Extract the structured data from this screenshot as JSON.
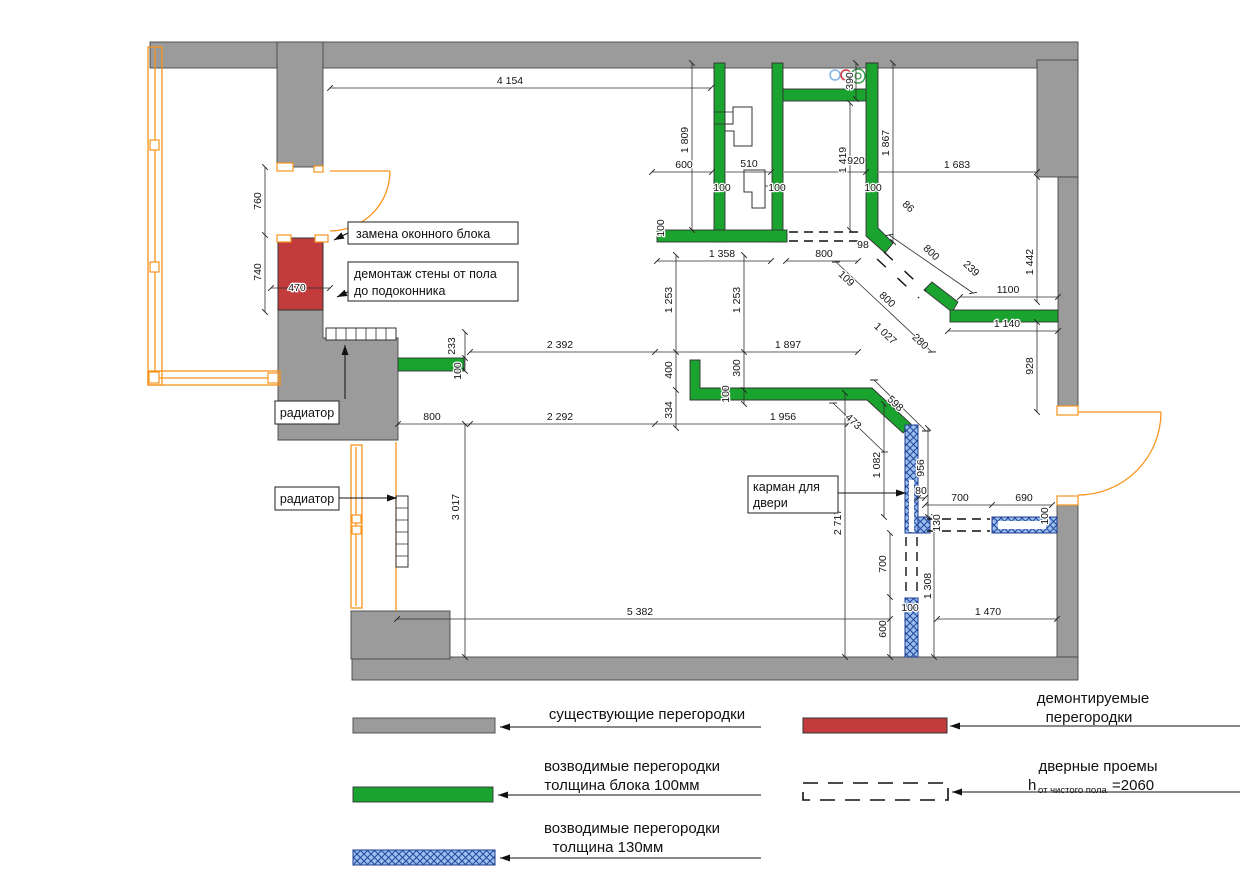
{
  "colors": {
    "wall_existing": "#9b9b9b",
    "wall_new_100": "#1aa32e",
    "wall_new_130_fill": "#9cc0ee",
    "wall_new_130_hatch": "#274a9e",
    "wall_demolished": "#c23b3d",
    "window_frame": "#f7941d",
    "riser_blue": "#85b7e8",
    "riser_red": "#d23a3a",
    "riser_green": "#2f9e44"
  },
  "plan_labels": {
    "window_replacement": "замена оконного блока",
    "wall_demolition_line1": "демонтаж стены от пола",
    "wall_demolition_line2": "до подоконника",
    "radiator_top": "радиатор",
    "radiator_left": "радиатор",
    "door_pocket_line1": "карман для",
    "door_pocket_line2": "двери"
  },
  "legend": {
    "existing": "существующие перегородки",
    "new100_line1": "возводимые перегородки",
    "new100_line2": "толщина блока 100мм",
    "new130_line1": "возводимые перегородки",
    "new130_line2": "толщина  130мм",
    "demolished_line1": "демонтируемые",
    "demolished_line2": "перегородки",
    "door_line1": "дверные проемы",
    "door_h": "h",
    "door_h_sub": "от чистого пола",
    "door_h_value": "=2060"
  },
  "dimensions": [
    {
      "t": "4 154",
      "x": 510,
      "y": 84,
      "r": 0
    },
    {
      "t": "600",
      "x": 684,
      "y": 168,
      "r": 0
    },
    {
      "t": "510",
      "x": 749,
      "y": 167,
      "r": 0
    },
    {
      "t": "920",
      "x": 856,
      "y": 164,
      "r": 0
    },
    {
      "t": "1 683",
      "x": 957,
      "y": 168,
      "r": 0
    },
    {
      "t": "100",
      "x": 722,
      "y": 191,
      "r": 0
    },
    {
      "t": "100",
      "x": 777,
      "y": 191,
      "r": 0
    },
    {
      "t": "100",
      "x": 873,
      "y": 191,
      "r": 0
    },
    {
      "t": "1 358",
      "x": 722,
      "y": 257,
      "r": 0
    },
    {
      "t": "800",
      "x": 824,
      "y": 257,
      "r": 0
    },
    {
      "t": "98",
      "x": 863,
      "y": 248,
      "r": 0
    },
    {
      "t": "470",
      "x": 297,
      "y": 291,
      "r": 0
    },
    {
      "t": "2 392",
      "x": 560,
      "y": 348,
      "r": 0
    },
    {
      "t": "1 897",
      "x": 788,
      "y": 348,
      "r": 0
    },
    {
      "t": "800",
      "x": 432,
      "y": 420,
      "r": 0
    },
    {
      "t": "2 292",
      "x": 560,
      "y": 420,
      "r": 0
    },
    {
      "t": "1 956",
      "x": 783,
      "y": 420,
      "r": 0
    },
    {
      "t": "1100",
      "x": 1008,
      "y": 293,
      "r": 0
    },
    {
      "t": "1 140",
      "x": 1007,
      "y": 327,
      "r": 0
    },
    {
      "t": "700",
      "x": 960,
      "y": 501,
      "r": 0
    },
    {
      "t": "690",
      "x": 1024,
      "y": 501,
      "r": 0
    },
    {
      "t": "80",
      "x": 921,
      "y": 494,
      "r": 0
    },
    {
      "t": "5 382",
      "x": 640,
      "y": 615,
      "r": 0
    },
    {
      "t": "1 470",
      "x": 988,
      "y": 615,
      "r": 0
    },
    {
      "t": "100",
      "x": 910,
      "y": 611,
      "r": 0
    },
    {
      "t": "760",
      "x": 261,
      "y": 201,
      "r": -90
    },
    {
      "t": "740",
      "x": 261,
      "y": 272,
      "r": -90
    },
    {
      "t": "1 809",
      "x": 688,
      "y": 140,
      "r": -90
    },
    {
      "t": "390",
      "x": 853,
      "y": 81,
      "r": -90
    },
    {
      "t": "1 419",
      "x": 846,
      "y": 160,
      "r": -90
    },
    {
      "t": "1 867",
      "x": 889,
      "y": 143,
      "r": -90
    },
    {
      "t": "1 442",
      "x": 1033,
      "y": 262,
      "r": -90
    },
    {
      "t": "928",
      "x": 1033,
      "y": 366,
      "r": -90
    },
    {
      "t": "100",
      "x": 664,
      "y": 228,
      "r": -90
    },
    {
      "t": "1 253",
      "x": 672,
      "y": 300,
      "r": -90
    },
    {
      "t": "1 253",
      "x": 740,
      "y": 300,
      "r": -90
    },
    {
      "t": "400",
      "x": 672,
      "y": 370,
      "r": -90
    },
    {
      "t": "334",
      "x": 672,
      "y": 410,
      "r": -90
    },
    {
      "t": "300",
      "x": 740,
      "y": 368,
      "r": -90
    },
    {
      "t": "100",
      "x": 729,
      "y": 394,
      "r": -90
    },
    {
      "t": "233",
      "x": 455,
      "y": 346,
      "r": -90
    },
    {
      "t": "100",
      "x": 461,
      "y": 371,
      "r": -90
    },
    {
      "t": "3 017",
      "x": 459,
      "y": 507,
      "r": -90
    },
    {
      "t": "2 717",
      "x": 841,
      "y": 522,
      "r": -90
    },
    {
      "t": "1 082",
      "x": 880,
      "y": 465,
      "r": -90
    },
    {
      "t": "956",
      "x": 924,
      "y": 468,
      "r": -90
    },
    {
      "t": "130",
      "x": 940,
      "y": 523,
      "r": -90
    },
    {
      "t": "100",
      "x": 1048,
      "y": 516,
      "r": -90
    },
    {
      "t": "700",
      "x": 886,
      "y": 564,
      "r": -90
    },
    {
      "t": "1 308",
      "x": 931,
      "y": 586,
      "r": -90
    },
    {
      "t": "600",
      "x": 886,
      "y": 629,
      "r": -90
    },
    {
      "t": "86",
      "x": 906,
      "y": 209,
      "r": 43
    },
    {
      "t": "800",
      "x": 929,
      "y": 255,
      "r": 43
    },
    {
      "t": "239",
      "x": 969,
      "y": 271,
      "r": 43
    },
    {
      "t": "109",
      "x": 844,
      "y": 281,
      "r": 43
    },
    {
      "t": "800",
      "x": 885,
      "y": 302,
      "r": 43
    },
    {
      "t": "1 027",
      "x": 883,
      "y": 336,
      "r": 43
    },
    {
      "t": "280",
      "x": 918,
      "y": 344,
      "r": 43
    },
    {
      "t": "598",
      "x": 893,
      "y": 406,
      "r": 43
    },
    {
      "t": "473",
      "x": 851,
      "y": 424,
      "r": 43
    }
  ]
}
